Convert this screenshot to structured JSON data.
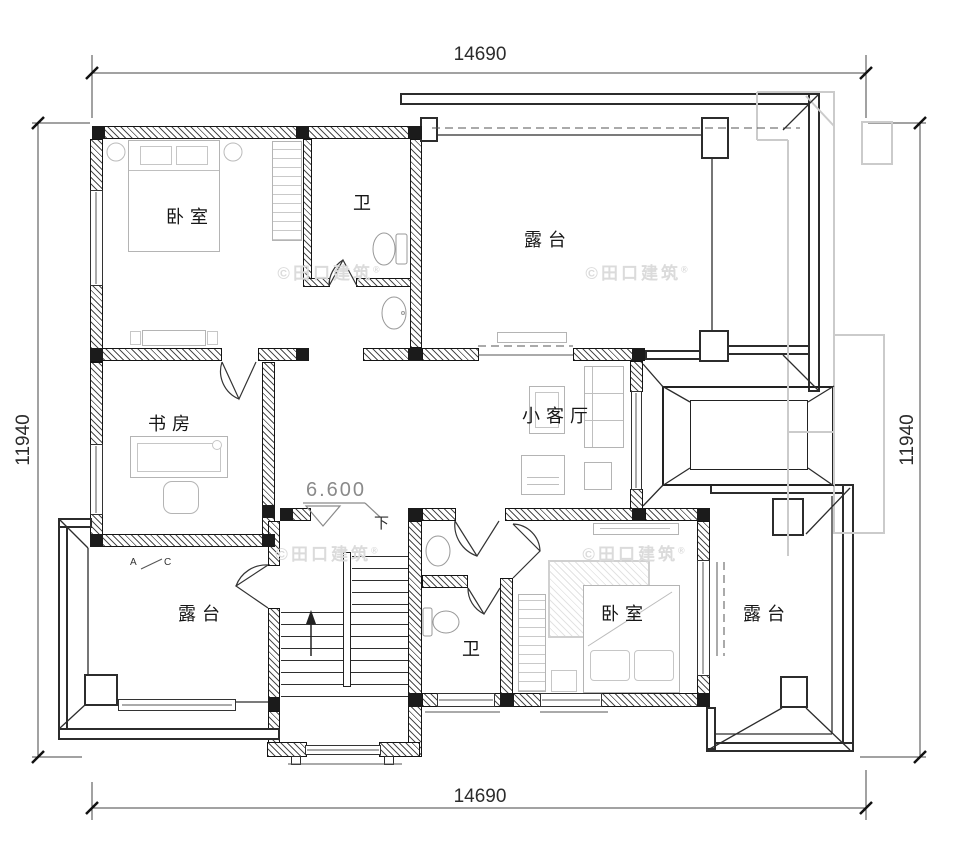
{
  "dimensions": {
    "top": "14690",
    "bottom": "14690",
    "left": "11940",
    "right": "11940"
  },
  "rooms": {
    "bedroom_top_left": "卧室",
    "bath_top": "卫",
    "terrace_top": "露台",
    "study": "书房",
    "living_small": "小客厅",
    "terrace_bottom_left": "露台",
    "bath_bottom": "卫",
    "bedroom_bottom_right": "卧室",
    "terrace_bottom_right": "露台"
  },
  "annotations": {
    "elevation": "6.600",
    "stair_direction": "下",
    "section_marker_a": "A",
    "section_marker_c": "C"
  },
  "watermark": {
    "text": "©田口建筑",
    "registered": "®"
  },
  "colors": {
    "background": "#ffffff",
    "wall_line": "#141414",
    "wall_hatch": "#4d4d4d",
    "column": "#1b1b1b",
    "parapet_line": "#2c2c2c",
    "ghost_roof": "#cbcbcb",
    "furniture_line": "#b4b4b4",
    "dimension_text": "#2c2c2c",
    "elevation_text": "#8a8a8a",
    "watermark_text": "#dbdbdb"
  }
}
